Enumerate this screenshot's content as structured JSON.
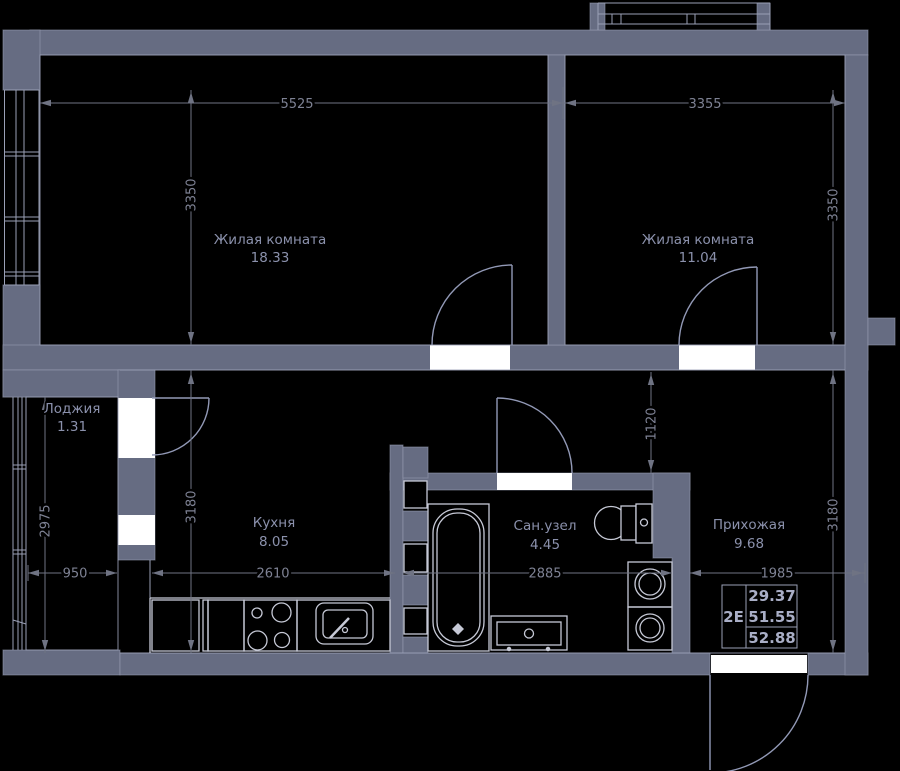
{
  "title": "Floor plan apartment 2E",
  "colors": {
    "background": "#000000",
    "wall": "#666c82",
    "wall_edge": "#9ba1b7",
    "line": "#9aa0b6",
    "fixture": "#c6c9d6",
    "door": "#9299b6",
    "dim": "#6f7383",
    "dim_text": "#7e8294",
    "room_text": "#8b91ac",
    "table_text": "#a9aec6",
    "opening": "#ffffff"
  },
  "rooms": [
    {
      "id": "living1",
      "name": "Жилая комната",
      "area": "18.33"
    },
    {
      "id": "living2",
      "name": "Жилая комната",
      "area": "11.04"
    },
    {
      "id": "loggia",
      "name": "Лоджия",
      "area": "1.31"
    },
    {
      "id": "kitchen",
      "name": "Кухня",
      "area": "8.05"
    },
    {
      "id": "bathroom",
      "name": "Сан.узел",
      "area": "4.45"
    },
    {
      "id": "hallway",
      "name": "Прихожая",
      "area": "9.68"
    }
  ],
  "dimensions": {
    "top_left_width": "5525",
    "top_right_width": "3355",
    "living1_height": "3350",
    "living2_height": "3350",
    "loggia_height": "2975",
    "loggia_width": "950",
    "kitchen_width": "2610",
    "kitchen_height": "3180",
    "bath_width": "2885",
    "hall_gap_height": "1120",
    "hall_width": "1985",
    "hall_height": "3180"
  },
  "summary_table": {
    "type_label": "2Е",
    "rows": [
      "29.37",
      "51.55",
      "52.88"
    ]
  },
  "fixtures": [
    "bathtub-icon",
    "toilet-icon",
    "vanity-sink-icon",
    "washing-machine-icon",
    "washing-machine-icon",
    "stove-icon",
    "kitchen-sink-icon",
    "kitchen-cabinet-icon",
    "window-icon",
    "door-arc-icon"
  ]
}
